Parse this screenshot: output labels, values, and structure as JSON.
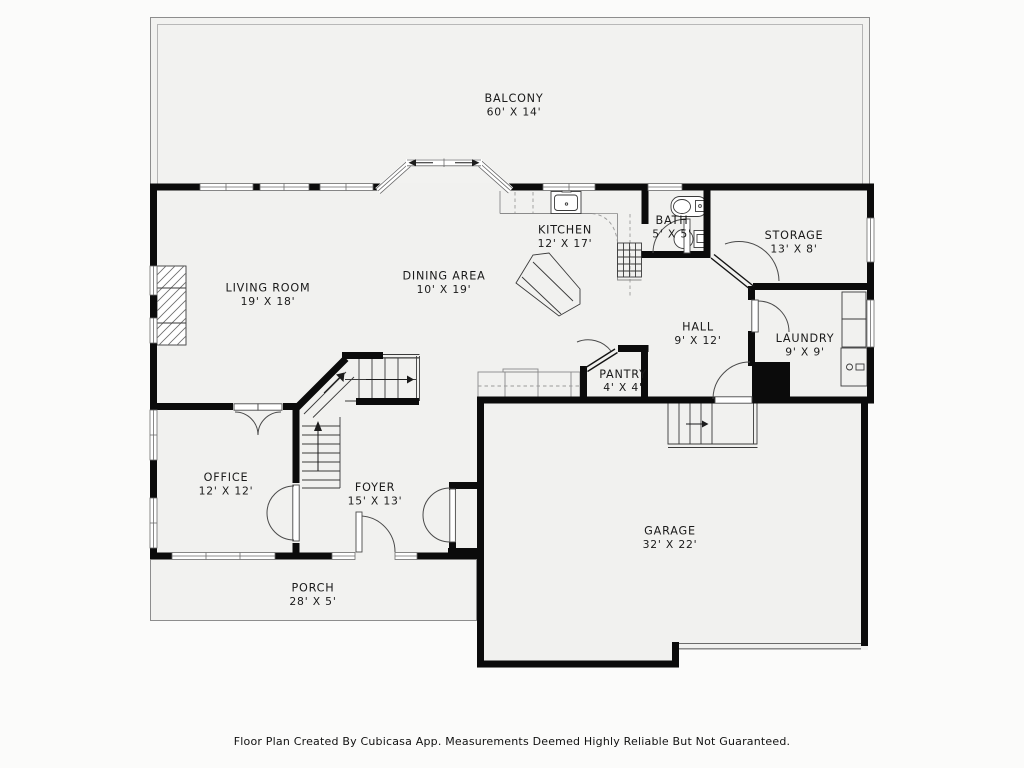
{
  "meta": {
    "footer": "Floor Plan Created By Cubicasa App. Measurements Deemed Highly Reliable But Not Guaranteed.",
    "colors": {
      "wall": "#0b0b0b",
      "floor": "#f1f1ef",
      "outdoor_floor": "#f2f2f0",
      "page": "#fbfbfa"
    }
  },
  "rooms": [
    {
      "id": "balcony",
      "name": "BALCONY",
      "dims": "60' X 14'"
    },
    {
      "id": "living-room",
      "name": "LIVING ROOM",
      "dims": "19' X 18'"
    },
    {
      "id": "dining-area",
      "name": "DINING AREA",
      "dims": "10' X 19'"
    },
    {
      "id": "kitchen",
      "name": "KITCHEN",
      "dims": "12' X 17'"
    },
    {
      "id": "bath",
      "name": "BATH",
      "dims": "5' X 5'"
    },
    {
      "id": "storage",
      "name": "STORAGE",
      "dims": "13' X 8'"
    },
    {
      "id": "hall",
      "name": "HALL",
      "dims": "9' X 12'"
    },
    {
      "id": "laundry",
      "name": "LAUNDRY",
      "dims": "9' X 9'"
    },
    {
      "id": "pantry",
      "name": "PANTRY",
      "dims": "4' X 4'"
    },
    {
      "id": "office",
      "name": "OFFICE",
      "dims": "12' X 12'"
    },
    {
      "id": "foyer",
      "name": "FOYER",
      "dims": "15' X 13'"
    },
    {
      "id": "garage",
      "name": "GARAGE",
      "dims": "32' X 22'"
    },
    {
      "id": "porch",
      "name": "PORCH",
      "dims": "28' X 5'"
    }
  ]
}
